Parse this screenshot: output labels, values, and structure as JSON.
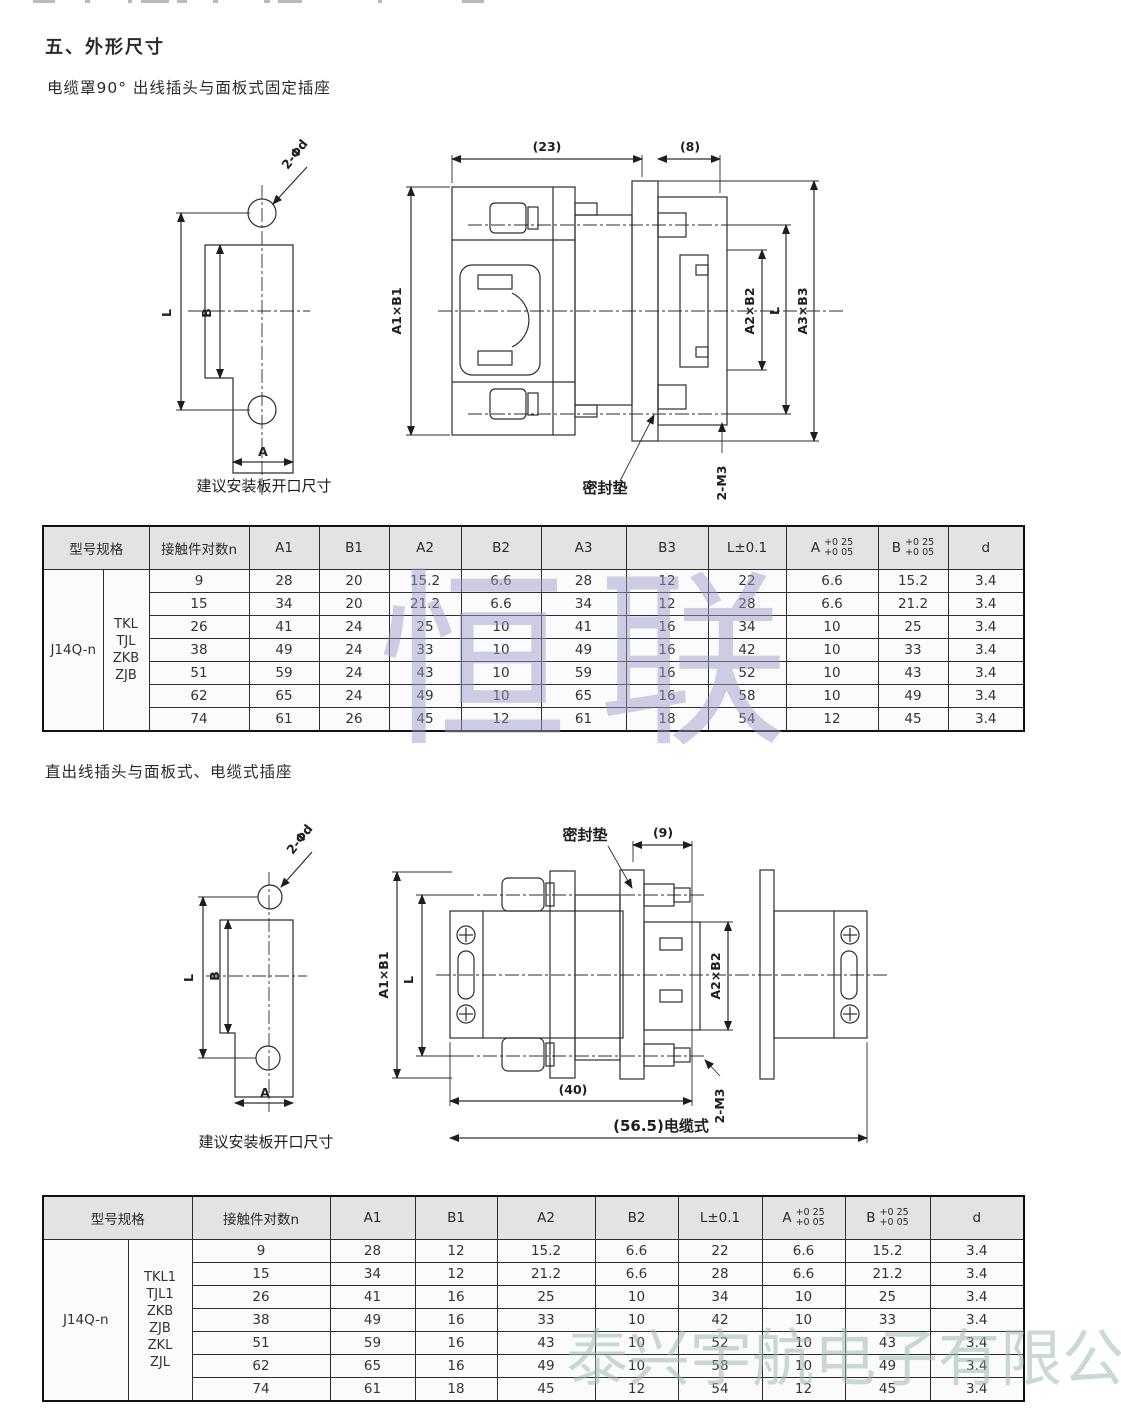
{
  "page": {
    "section_title": "五、外形尺寸",
    "subtitle1": "电缆罩90° 出线插头与面板式固定插座",
    "subtitle2": "直出线插头与面板式、电缆式插座",
    "watermark_center": "恒联",
    "watermark_bottom": "泰兴宇航电子有限公司"
  },
  "drawing1": {
    "caption": "建议安装板开口尺寸",
    "labels": {
      "holes": "2-Φd",
      "l": "L",
      "b": "B",
      "a": "A",
      "dim23": "(23)",
      "dim8": "(8)",
      "a1b1": "A1×B1",
      "a2b2": "A2×B2",
      "l2": "L",
      "a3b3": "A3×B3",
      "m3": "2-M3",
      "seal": "密封垫"
    }
  },
  "drawing2": {
    "caption": "建议安装板开口尺寸",
    "labels": {
      "holes": "2-Φd",
      "l": "L",
      "b": "B",
      "a": "A",
      "seal": "密封垫",
      "dim9": "(9)",
      "a1b1": "A1×B1",
      "l2": "L",
      "a2b2": "A2×B2",
      "m3": "2-M3",
      "dim40": "(40)",
      "dim56": "(56.5)电缆式"
    }
  },
  "table1": {
    "header": {
      "model": "型号规格",
      "n": "接触件对数n",
      "a1": "A1",
      "b1": "B1",
      "a2": "A2",
      "b2": "B2",
      "a3": "A3",
      "b3": "B3",
      "l": "L±0.1",
      "a_base": "A",
      "b_base": "B",
      "tol_top": "+0 25",
      "tol_bot": "+0 05",
      "d": "d"
    },
    "model": "J14Q-n",
    "types": [
      "TKL",
      "TJL",
      "ZKB",
      "ZJB"
    ],
    "rows": [
      [
        "9",
        "28",
        "20",
        "15.2",
        "6.6",
        "28",
        "12",
        "22",
        "6.6",
        "15.2",
        "3.4"
      ],
      [
        "15",
        "34",
        "20",
        "21.2",
        "6.6",
        "34",
        "12",
        "28",
        "6.6",
        "21.2",
        "3.4"
      ],
      [
        "26",
        "41",
        "24",
        "25",
        "10",
        "41",
        "16",
        "34",
        "10",
        "25",
        "3.4"
      ],
      [
        "38",
        "49",
        "24",
        "33",
        "10",
        "49",
        "16",
        "42",
        "10",
        "33",
        "3.4"
      ],
      [
        "51",
        "59",
        "24",
        "43",
        "10",
        "59",
        "16",
        "52",
        "10",
        "43",
        "3.4"
      ],
      [
        "62",
        "65",
        "24",
        "49",
        "10",
        "65",
        "16",
        "58",
        "10",
        "49",
        "3.4"
      ],
      [
        "74",
        "61",
        "26",
        "45",
        "12",
        "61",
        "18",
        "54",
        "12",
        "45",
        "3.4"
      ]
    ]
  },
  "table2": {
    "header": {
      "model": "型号规格",
      "n": "接触件对数n",
      "a1": "A1",
      "b1": "B1",
      "a2": "A2",
      "b2": "B2",
      "l": "L±0.1",
      "a_base": "A",
      "b_base": "B",
      "tol_top": "+0 25",
      "tol_bot": "+0 05",
      "d": "d"
    },
    "model": "J14Q-n",
    "types": [
      "TKL1",
      "TJL1",
      "ZKB",
      "ZJB",
      "ZKL",
      "ZJL"
    ],
    "rows": [
      [
        "9",
        "28",
        "12",
        "15.2",
        "6.6",
        "22",
        "6.6",
        "15.2",
        "3.4"
      ],
      [
        "15",
        "34",
        "12",
        "21.2",
        "6.6",
        "28",
        "6.6",
        "21.2",
        "3.4"
      ],
      [
        "26",
        "41",
        "16",
        "25",
        "10",
        "34",
        "10",
        "25",
        "3.4"
      ],
      [
        "38",
        "49",
        "16",
        "33",
        "10",
        "42",
        "10",
        "33",
        "3.4"
      ],
      [
        "51",
        "59",
        "16",
        "43",
        "10",
        "52",
        "10",
        "43",
        "3.4"
      ],
      [
        "62",
        "65",
        "16",
        "49",
        "10",
        "58",
        "10",
        "49",
        "3.4"
      ],
      [
        "74",
        "61",
        "18",
        "45",
        "12",
        "54",
        "12",
        "45",
        "3.4"
      ]
    ]
  }
}
